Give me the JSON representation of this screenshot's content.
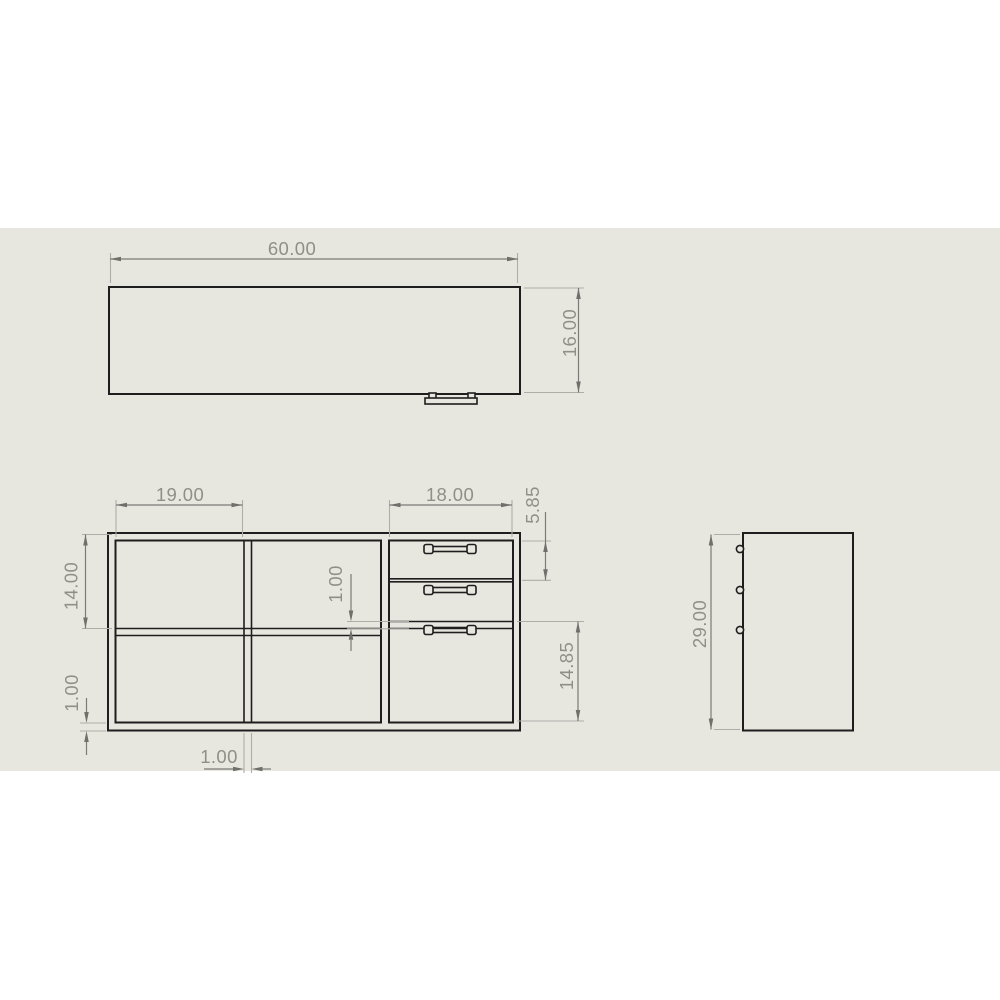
{
  "colors": {
    "background": "#ffffff",
    "sheet": "#e8e7df",
    "object_lines": "#1e1e1e",
    "dimension_lines": "#7a7a76",
    "extension_lines": "#aeaea8",
    "dimension_text": "#8f8f8a"
  },
  "views": {
    "top": {
      "dims": {
        "width": "60.00",
        "depth": "16.00"
      }
    },
    "front": {
      "dims": {
        "left_opening": "19.00",
        "drawer_opening": "18.00",
        "top_drawer": "5.85",
        "upper_opening": "14.00",
        "drawer_gap": "1.00",
        "bottom_panel": "1.00",
        "bottom_drawer": "14.85",
        "divider": "1.00"
      }
    },
    "side": {
      "dims": {
        "height": "29.00"
      }
    }
  }
}
